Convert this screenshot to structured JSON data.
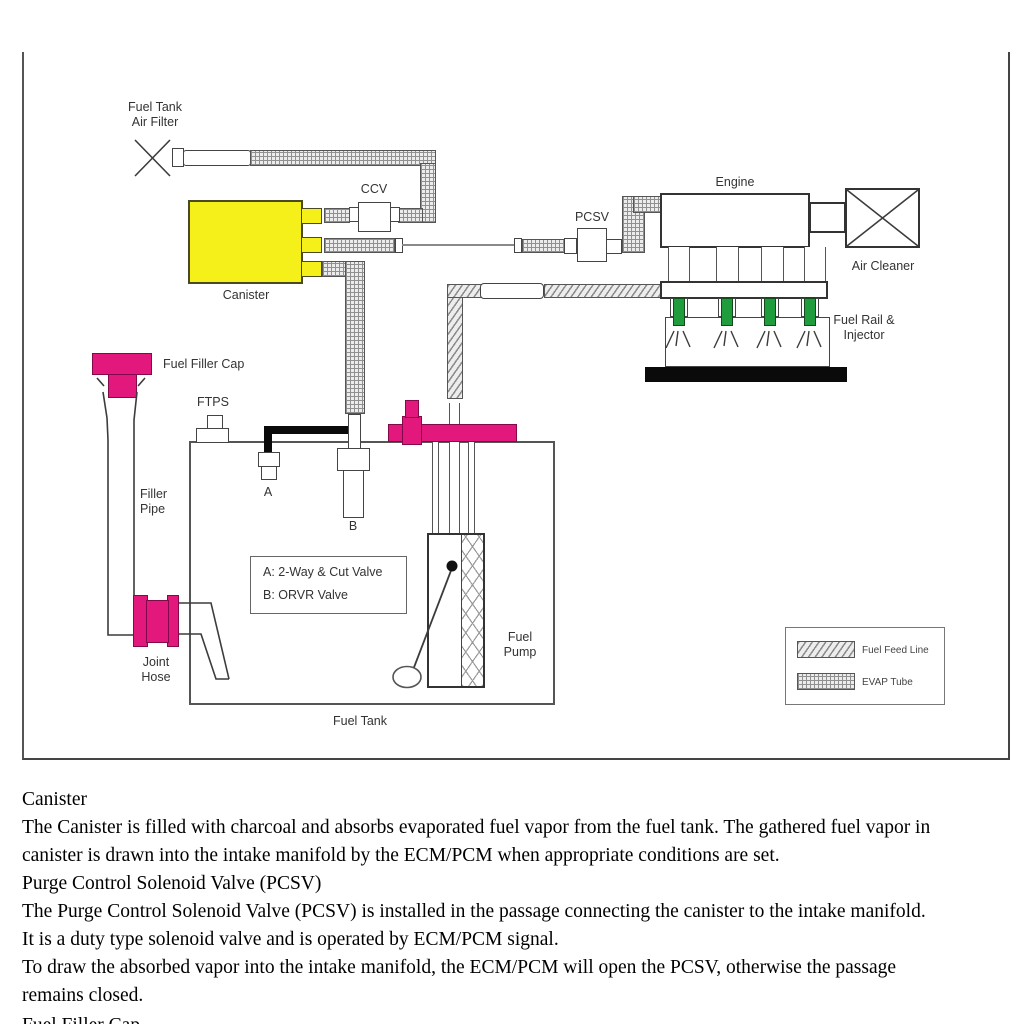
{
  "diagram": {
    "labels": {
      "air_filter_l1": "Fuel Tank",
      "air_filter_l2": "Air Filter",
      "ccv": "CCV",
      "pcsv": "PCSV",
      "engine": "Engine",
      "air_cleaner": "Air Cleaner",
      "fuel_rail_l1": "Fuel Rail &",
      "fuel_rail_l2": "Injector",
      "canister": "Canister",
      "fuel_filler_cap": "Fuel Filler Cap",
      "ftps": "FTPS",
      "filler_l1": "Filler",
      "filler_l2": "Pipe",
      "valve_a": "A",
      "valve_b": "B",
      "key_a": "A: 2-Way & Cut Valve",
      "key_b": "B: ORVR Valve",
      "fuel_pump_l1": "Fuel",
      "fuel_pump_l2": "Pump",
      "joint_l1": "Joint",
      "joint_l2": "Hose",
      "fuel_tank": "Fuel Tank"
    },
    "legend": {
      "fuel_feed": "Fuel Feed Line",
      "evap": "EVAP Tube"
    },
    "colors": {
      "canister_yellow": "#f5ef1a",
      "magenta": "#e2187d",
      "injector_green": "#1f9c3c",
      "hose_black": "#0a0a0a"
    }
  },
  "article": {
    "lines": [
      "Canister",
      "The Canister is filled with charcoal and absorbs evaporated fuel vapor from the fuel tank. The gathered fuel vapor in",
      "canister is drawn into the intake manifold by the ECM/PCM when appropriate conditions are set.",
      "Purge Control Solenoid Valve (PCSV)",
      "The Purge Control Solenoid Valve (PCSV) is installed in the passage connecting the canister to the intake manifold.",
      "It is a duty type solenoid valve and is operated by ECM/PCM signal.",
      "To draw the absorbed vapor into the intake manifold, the ECM/PCM will open the PCSV, otherwise the passage",
      "remains closed.",
      "Fuel Filler Cap"
    ]
  }
}
